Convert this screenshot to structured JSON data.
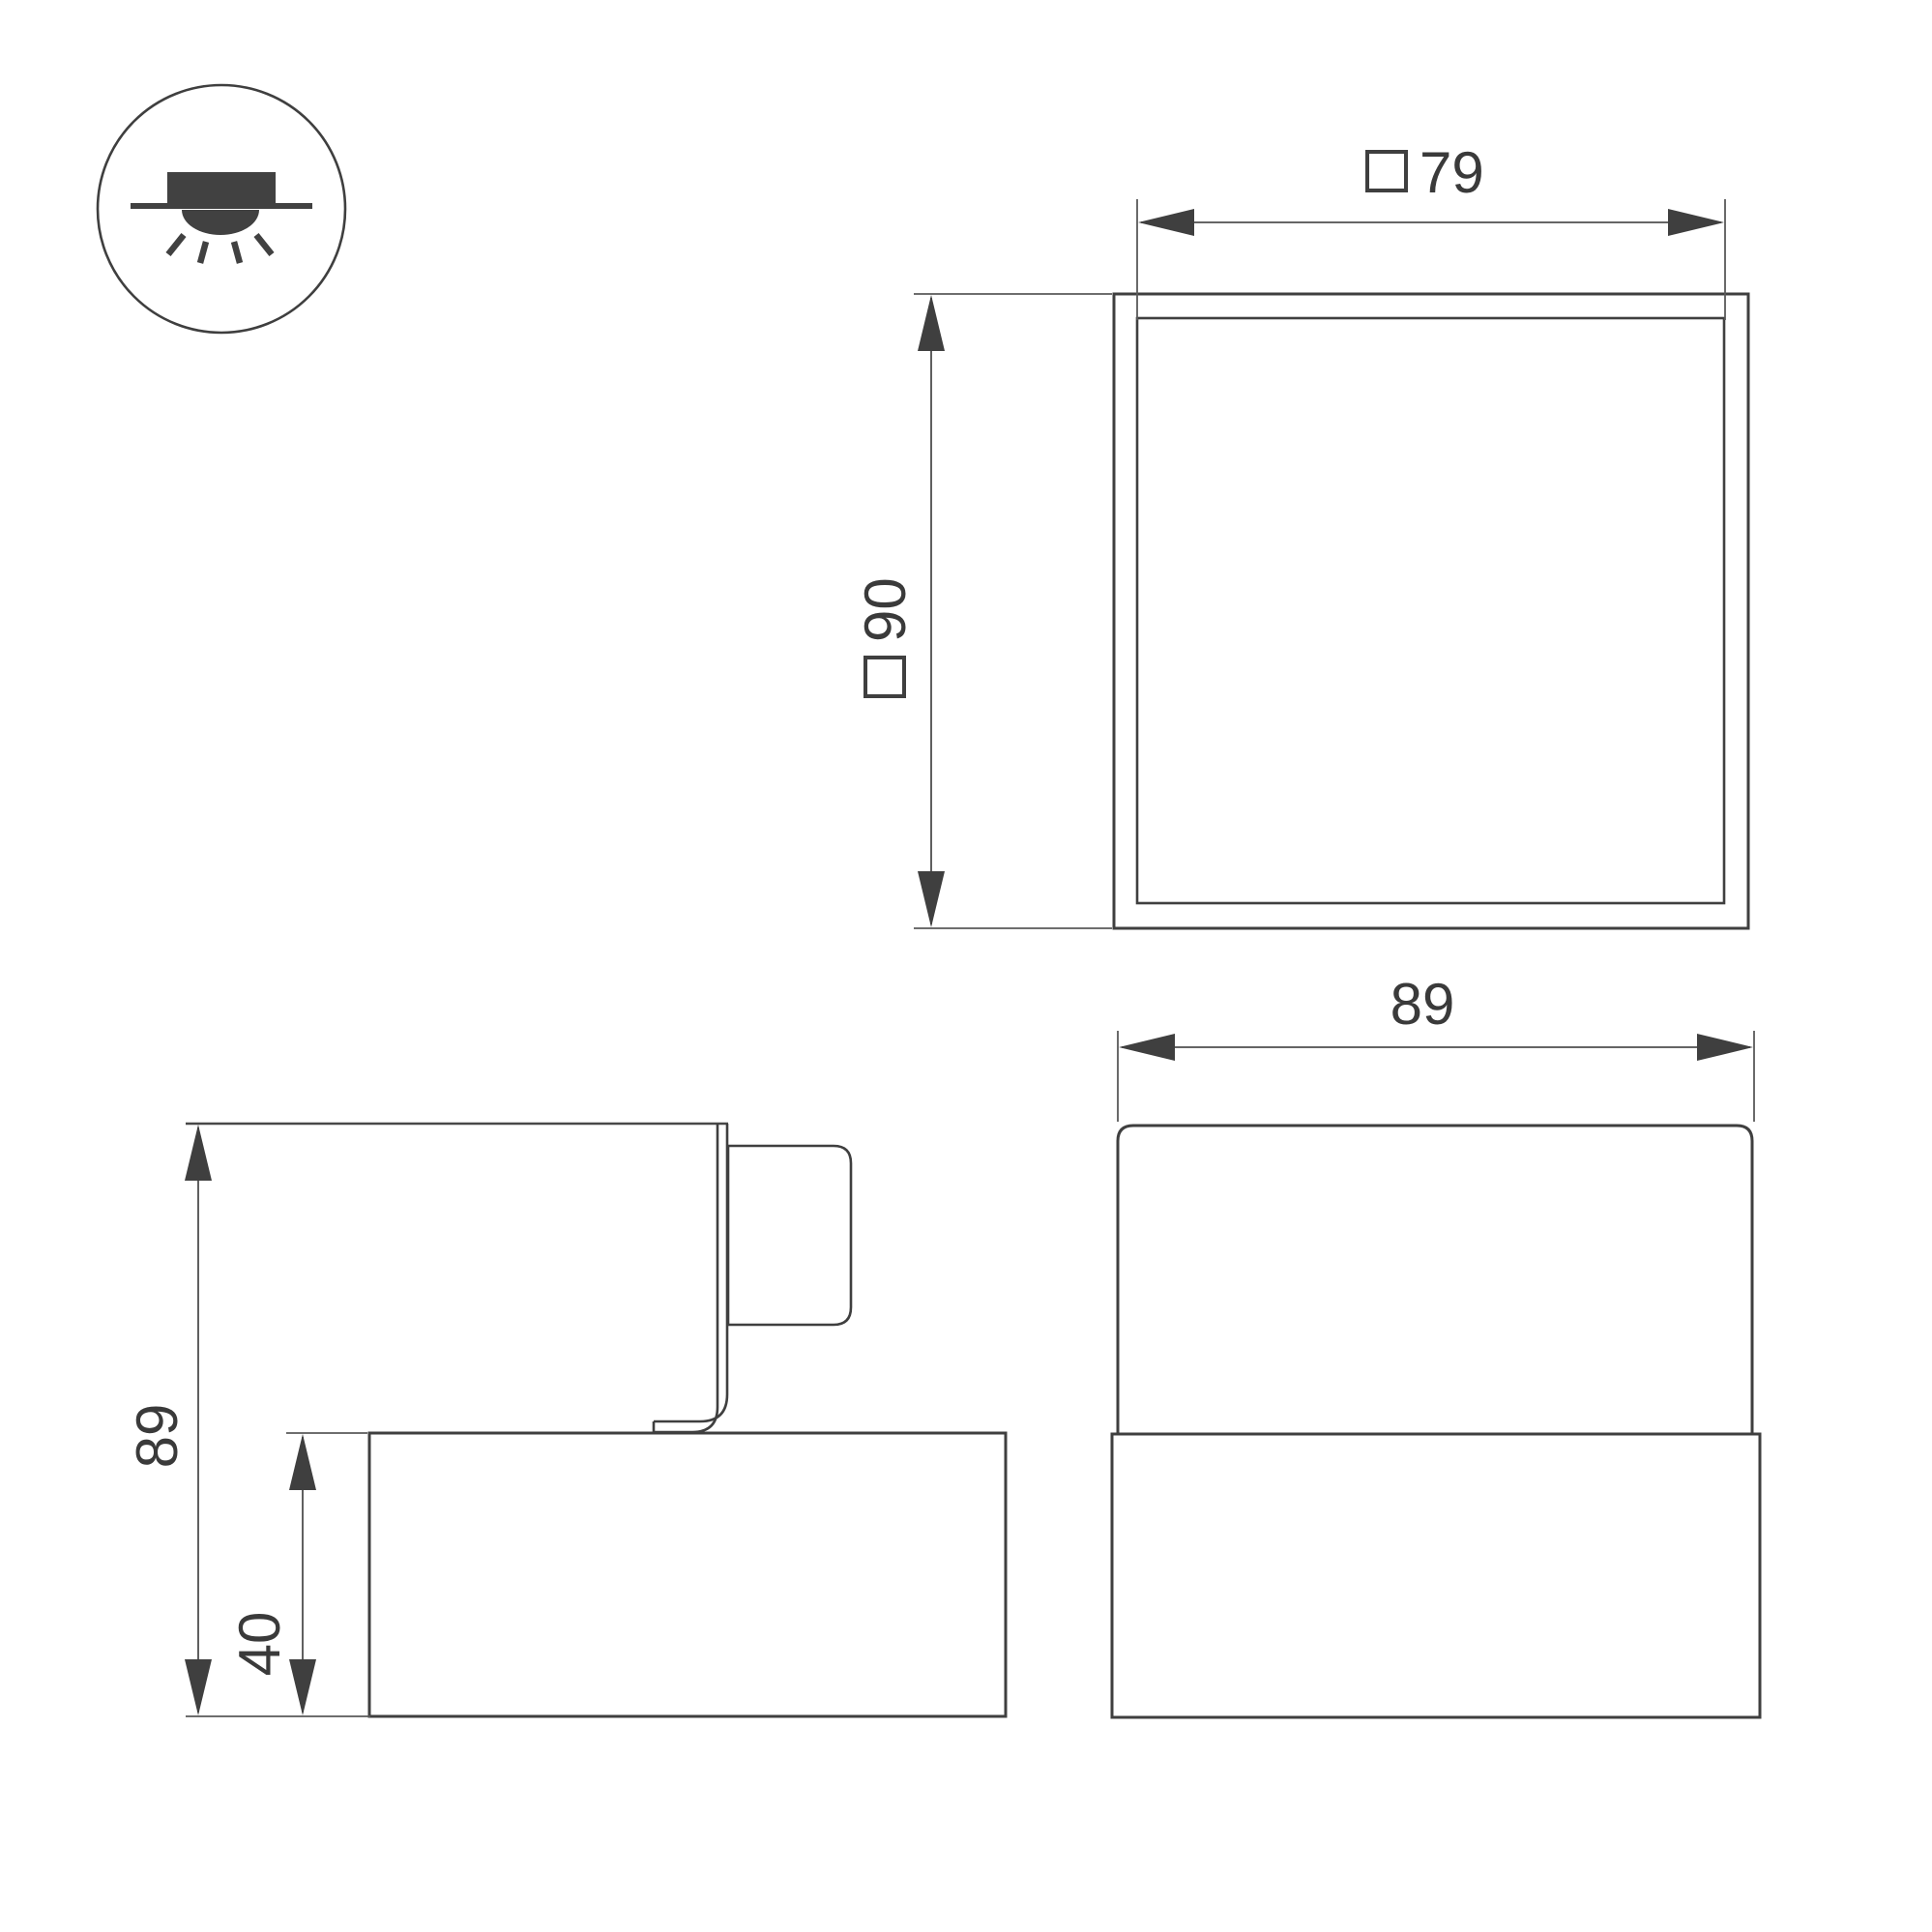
{
  "page": {
    "background": "#ffffff"
  },
  "palette": {
    "outline_color": "#3f3f3f",
    "dimension_color": "#4f4f4f",
    "text_color": "#3a3a3a"
  },
  "mount_icon": {
    "name": "surface-mounted-downlight"
  },
  "top_view": {
    "aperture_dim": {
      "square_prefix": "□",
      "value": "79"
    },
    "outer_dim": {
      "square_prefix": "□",
      "value": "90"
    }
  },
  "side_view": {
    "overall_height_dim": {
      "value": "89"
    },
    "base_height_dim": {
      "value": "40"
    }
  },
  "front_view": {
    "overall_width_dim": {
      "value": "89"
    }
  }
}
